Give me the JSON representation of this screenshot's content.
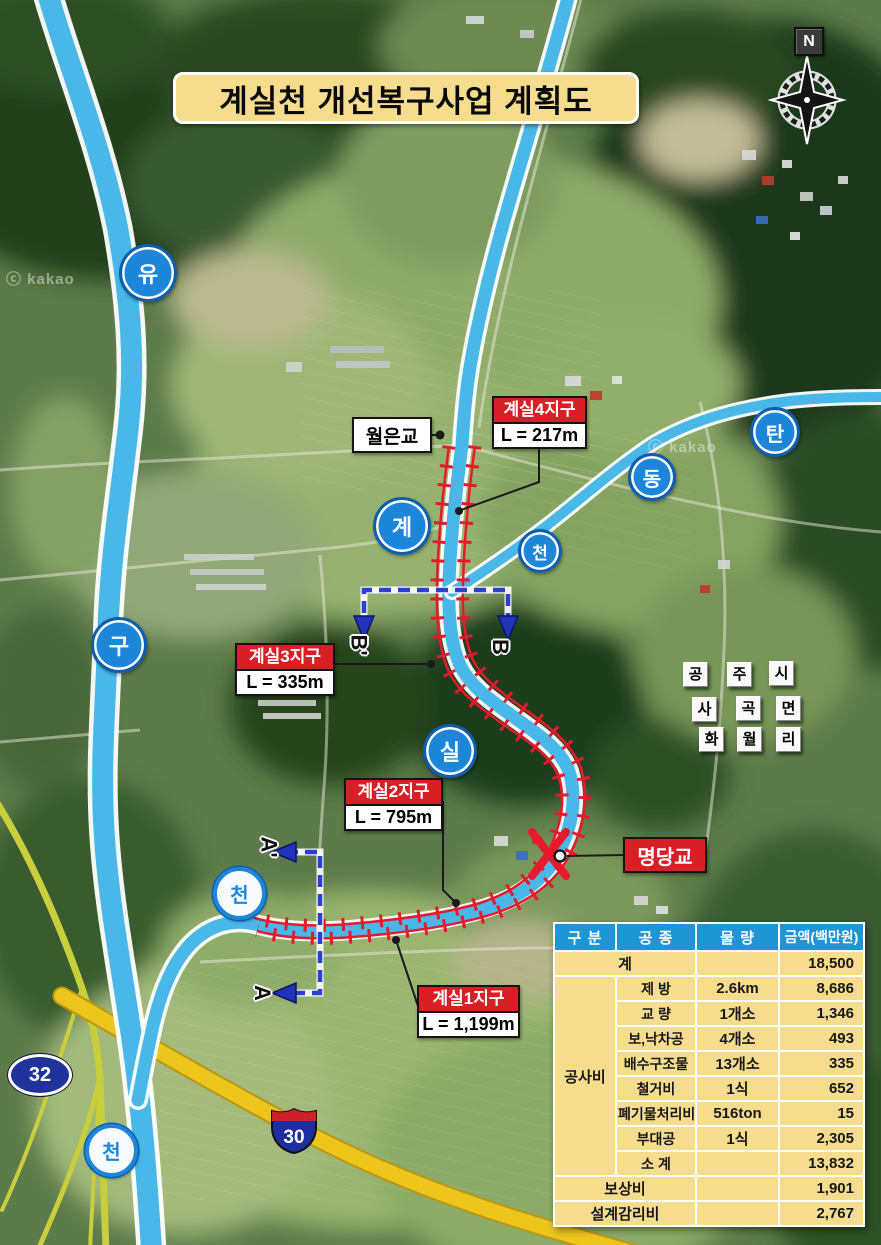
{
  "title": "계실천 개선복구사업 계획도",
  "compass_label": "N",
  "watermarks": [
    "ⓒ kakao",
    "ⓒ kakao"
  ],
  "shields": {
    "route32": "32",
    "route30": "30"
  },
  "bridges": {
    "woleun": "월은교",
    "myeongdang": "명당교"
  },
  "sections": [
    {
      "name": "계실4지구",
      "length": "L = 217m"
    },
    {
      "name": "계실3지구",
      "length": "L = 335m"
    },
    {
      "name": "계실2지구",
      "length": "L = 795m"
    },
    {
      "name": "계실1지구",
      "length": "L = 1,199m"
    }
  ],
  "river_badges": [
    "유",
    "구",
    "천",
    "계",
    "천",
    "실",
    "천",
    "탄",
    "동"
  ],
  "region": {
    "row1": [
      "공",
      "주",
      "시"
    ],
    "row2": [
      "사",
      "곡",
      "면"
    ],
    "row3": [
      "화",
      "월",
      "리"
    ]
  },
  "section_letters": {
    "b_prime": "B'",
    "b": "B",
    "a_prime": "A'",
    "a": "A"
  },
  "table": {
    "headers": [
      "구 분",
      "공 종",
      "물 량",
      "금액(백만원)"
    ],
    "total_row": {
      "label": "계",
      "qty": "",
      "amount": "18,500"
    },
    "cost_group_label": "공사비",
    "cost_rows": [
      {
        "work": "제 방",
        "qty": "2.6km",
        "amount": "8,686"
      },
      {
        "work": "교 량",
        "qty": "1개소",
        "amount": "1,346"
      },
      {
        "work": "보,낙차공",
        "qty": "4개소",
        "amount": "493"
      },
      {
        "work": "배수구조물",
        "qty": "13개소",
        "amount": "335"
      },
      {
        "work": "철거비",
        "qty": "1식",
        "amount": "652"
      },
      {
        "work": "폐기물처리비",
        "qty": "516ton",
        "amount": "15"
      },
      {
        "work": "부대공",
        "qty": "1식",
        "amount": "2,305"
      },
      {
        "work": "소 계",
        "qty": "",
        "amount": "13,832"
      }
    ],
    "footer_rows": [
      {
        "label": "보상비",
        "amount": "1,901"
      },
      {
        "label": "설계감리비",
        "amount": "2,767"
      }
    ]
  },
  "colors": {
    "accent_red": "#d91f26",
    "table_header_blue": "#1e95d4",
    "panel_tan": "#f6dd8e",
    "river_blue": "#49b8e9",
    "road_yellow": "#ecc51d",
    "section_line_blue": "#2b3fd0",
    "badge_blue": "#1d86d8"
  }
}
